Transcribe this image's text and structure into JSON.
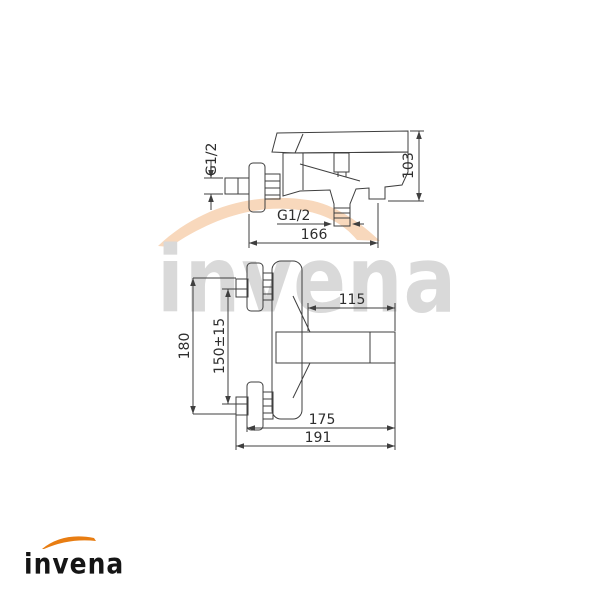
{
  "page": {
    "background": "#ffffff"
  },
  "watermark": {
    "text": "invena",
    "text_color": "#d9d9d9",
    "swoosh_color": "#f8d8bc"
  },
  "brand_logo": {
    "text": "invena",
    "text_color": "#151515",
    "swoosh_color": "#e87d12"
  },
  "drawing": {
    "line_color": "#3f3f3f",
    "label_color": "#2e2e2e",
    "side_view": {
      "description": "bath mixer tap - side elevation",
      "labels": {
        "wall_thread": "G1/2",
        "total_height": "103",
        "outlet_thread": "G1/2",
        "total_depth": "166"
      }
    },
    "top_view": {
      "description": "bath mixer tap - plan view",
      "labels": {
        "spout_reach": "115",
        "total_width": "180",
        "inlet_spacing": "150±15",
        "depth_to_spout_tip": "175",
        "total_depth": "191"
      }
    }
  }
}
